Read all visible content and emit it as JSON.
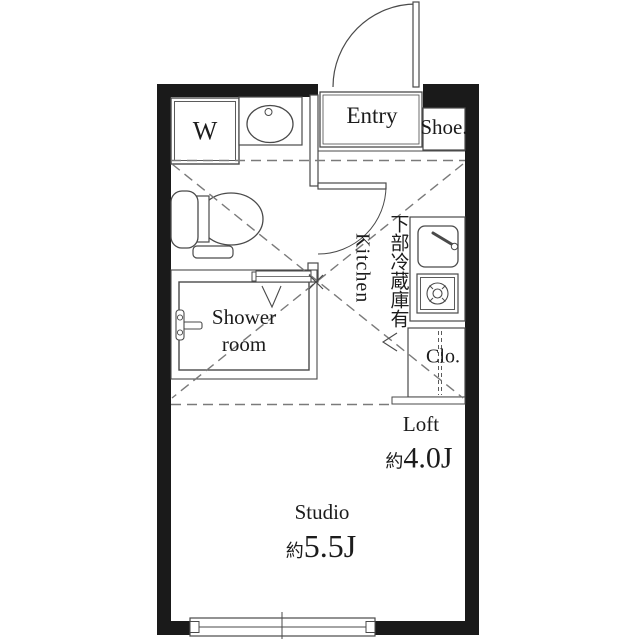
{
  "colors": {
    "wall": "#1a1a1a",
    "line": "#4a4a4a",
    "dashed_line": "#7a7a7a",
    "text": "#1c1c1c",
    "background": "#ffffff"
  },
  "rooms": {
    "washer": {
      "label": "W"
    },
    "entry": {
      "label": "Entry"
    },
    "shoe_closet": {
      "label": "Shoe."
    },
    "kitchen": {
      "label": "Kitchen"
    },
    "kitchen_note": {
      "label": "下部冷蔵庫有"
    },
    "shower": {
      "line1": "Shower",
      "line2": "room"
    },
    "closet": {
      "label": "Clo."
    },
    "loft": {
      "label": "Loft",
      "size_prefix": "約",
      "size_value": "4.0J"
    },
    "studio": {
      "label": "Studio",
      "size_prefix": "約",
      "size_value": "5.5J"
    }
  }
}
